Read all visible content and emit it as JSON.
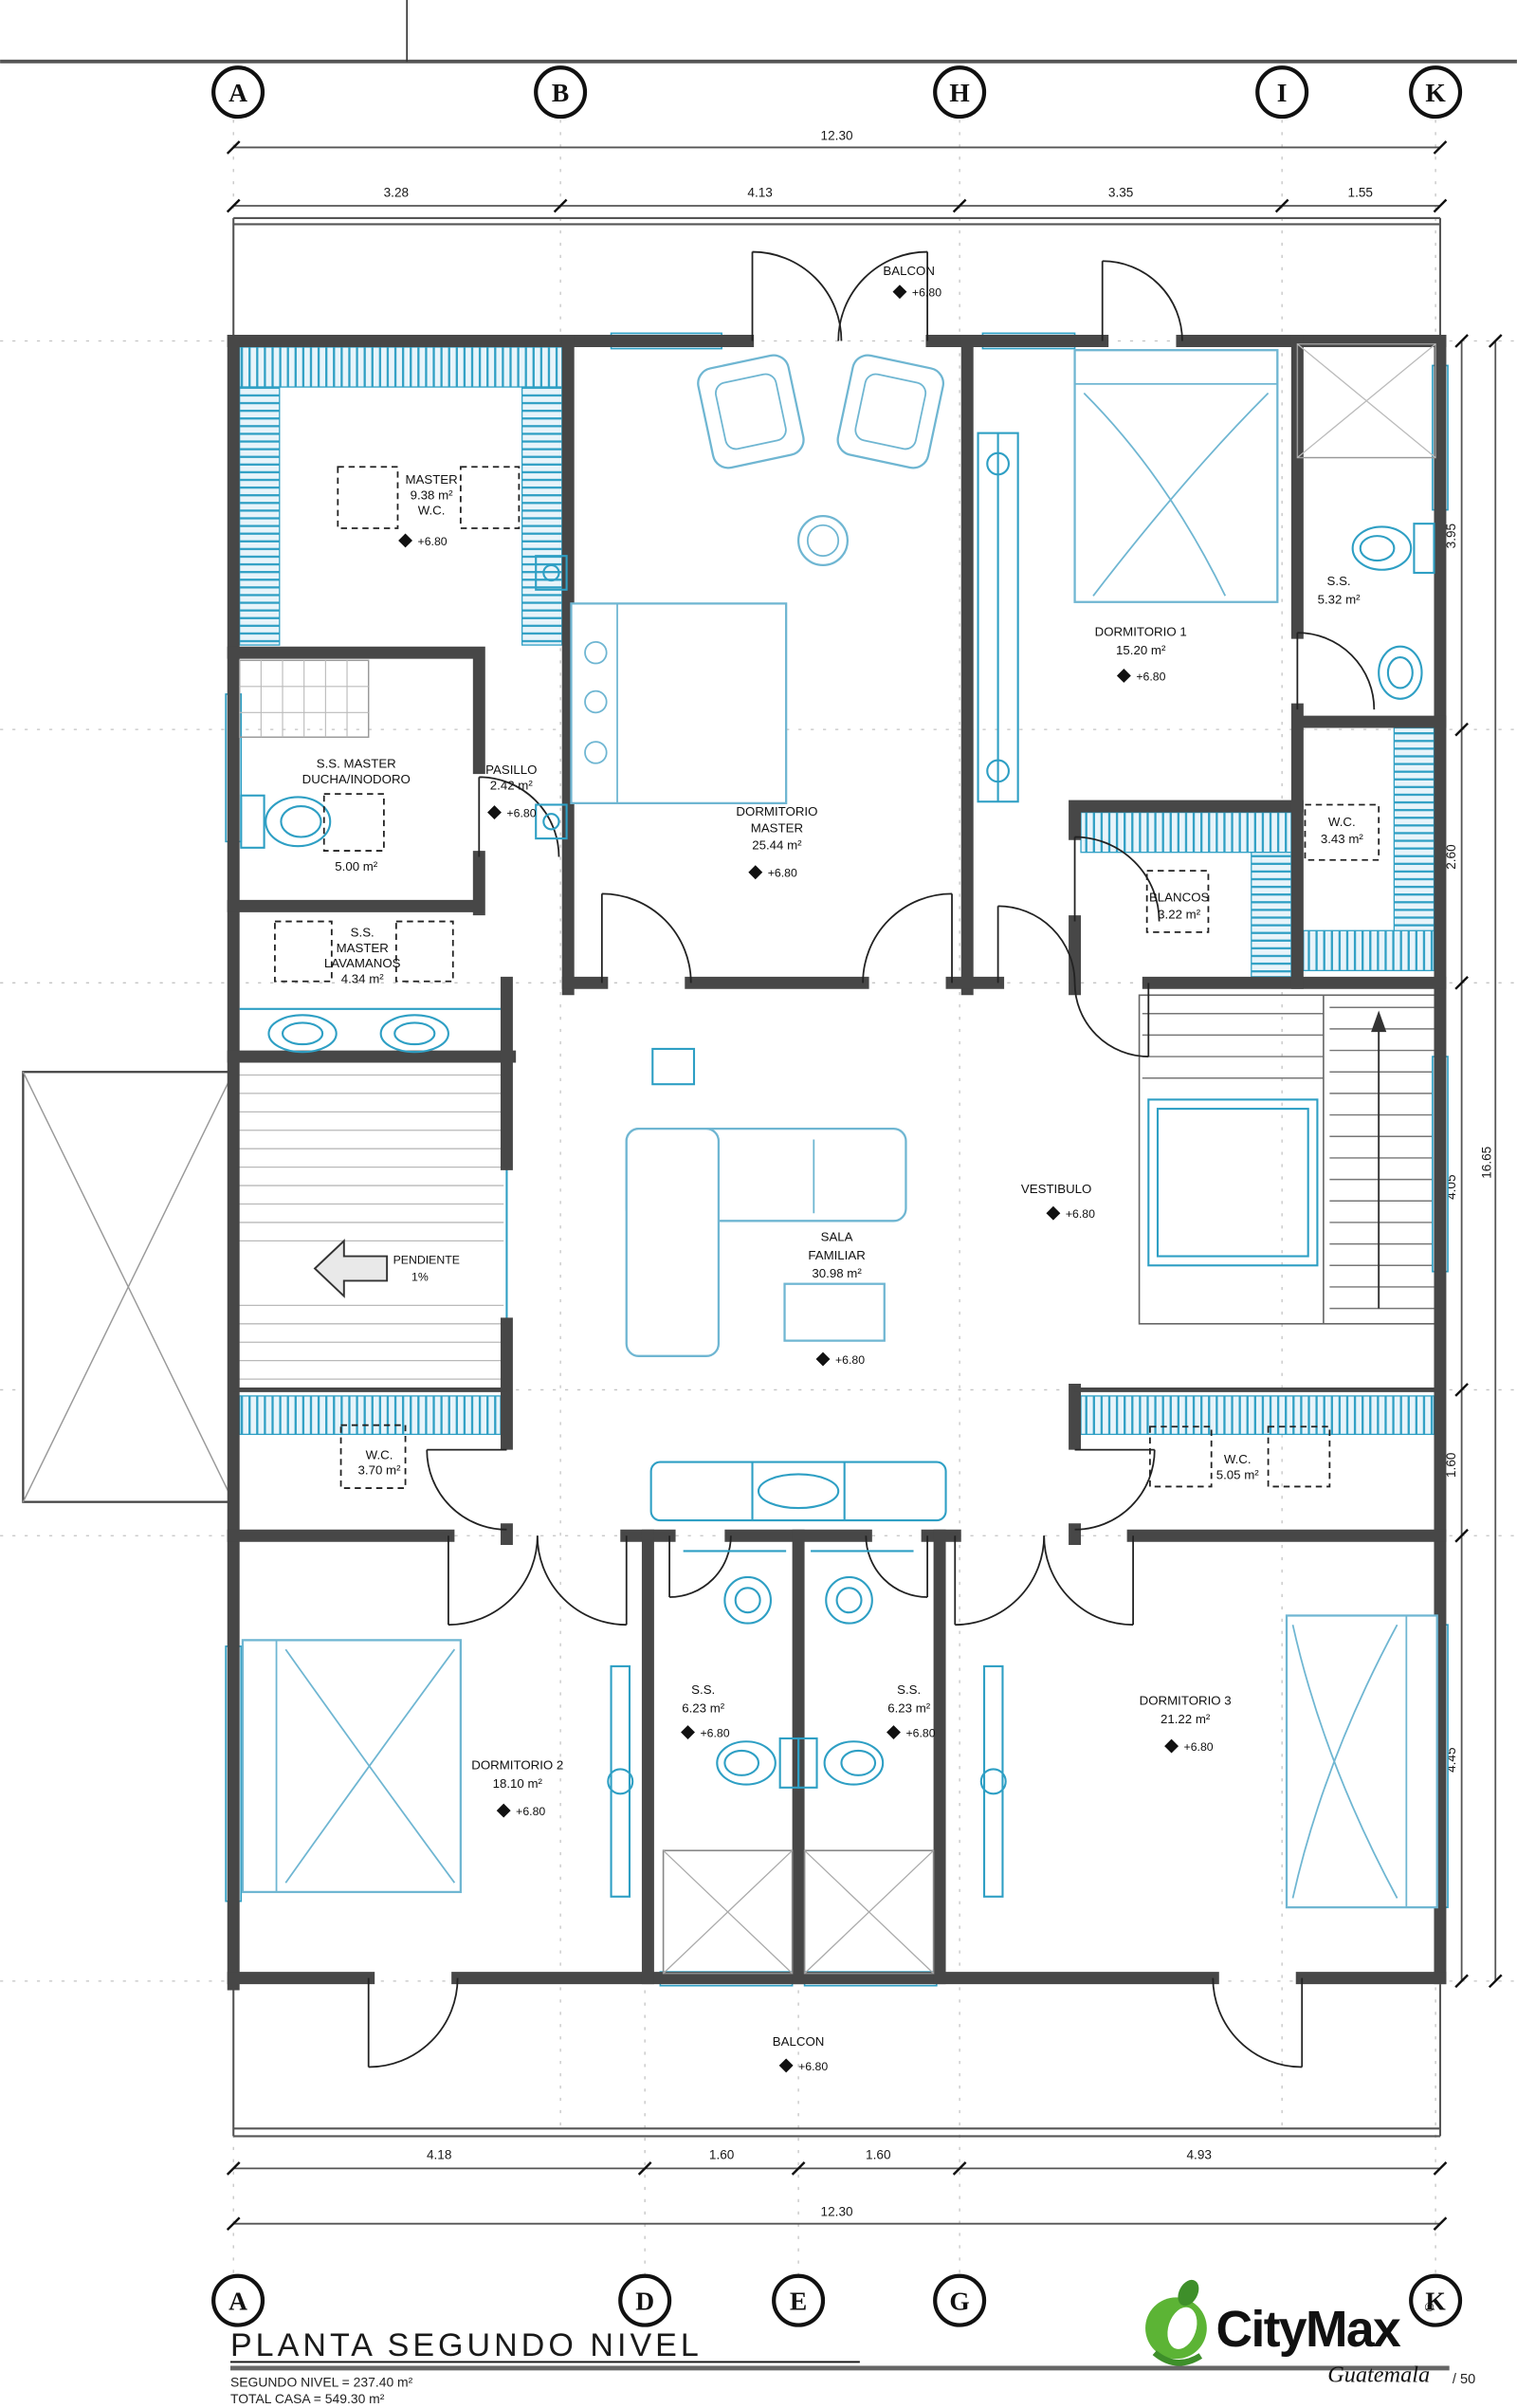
{
  "drawing": {
    "title": "PLANTA SEGUNDO NIVEL",
    "stats_line1": "SEGUNDO NIVEL = 237.40 m²",
    "stats_line2": "TOTAL CASA = 549.30 m²"
  },
  "logo": {
    "brand": "CityMax",
    "registered": "®",
    "region": "Guatemala",
    "scale_suffix": "/ 50"
  },
  "grid": {
    "top": [
      "A",
      "B",
      "H",
      "I",
      "K"
    ],
    "bottom": [
      "A",
      "D",
      "E",
      "G",
      "K"
    ]
  },
  "dims": {
    "top_total": "12.30",
    "top_segs": [
      "3.28",
      "4.13",
      "3.35",
      "1.55"
    ],
    "bottom_segs": [
      "4.18",
      "1.60",
      "1.60",
      "4.93"
    ],
    "bottom_total": "12.30",
    "right_segs": [
      "3.95",
      "2.60",
      "4.05",
      "1.60",
      "4.45"
    ],
    "right_total": "16.65"
  },
  "levels": {
    "value": "+6.80"
  },
  "rooms": {
    "balcon_top": {
      "name": "BALCON"
    },
    "master_wc": {
      "l1": "MASTER",
      "l2": "9.38 m²",
      "l3": "W.C."
    },
    "ss_ducha": {
      "l1": "S.S. MASTER",
      "l2": "DUCHA/INODORO",
      "area": "5.00 m²"
    },
    "pasillo": {
      "l1": "PASILLO",
      "l2": "2.42 m²"
    },
    "dorm_master": {
      "l1": "DORMITORIO",
      "l2": "MASTER",
      "l3": "25.44 m²"
    },
    "lavamanos": {
      "l1": "S.S.",
      "l2": "MASTER",
      "l3": "LAVAMANOS",
      "l4": "4.34 m²"
    },
    "dorm1": {
      "l1": "DORMITORIO 1",
      "l2": "15.20 m²"
    },
    "ss1": {
      "l1": "S.S.",
      "l2": "5.32 m²"
    },
    "wc343": {
      "l1": "W.C.",
      "l2": "3.43 m²"
    },
    "blancos": {
      "l1": "BLANCOS",
      "l2": "3.22 m²"
    },
    "vestibulo": {
      "l1": "VESTIBULO"
    },
    "sala": {
      "l1": "SALA",
      "l2": "FAMILIAR",
      "l3": "30.98 m²"
    },
    "pendiente": {
      "l1": "PENDIENTE",
      "l2": "1%"
    },
    "wc370": {
      "l1": "W.C.",
      "l2": "3.70 m²"
    },
    "wc505": {
      "l1": "W.C.",
      "l2": "5.05 m²"
    },
    "dorm2": {
      "l1": "DORMITORIO 2",
      "l2": "18.10 m²"
    },
    "ss623_left": {
      "l1": "S.S.",
      "l2": "6.23 m²"
    },
    "ss623_right": {
      "l1": "S.S.",
      "l2": "6.23 m²"
    },
    "dorm3": {
      "l1": "DORMITORIO 3",
      "l2": "21.22 m²"
    },
    "balcon_bottom": {
      "name": "BALCON"
    }
  }
}
